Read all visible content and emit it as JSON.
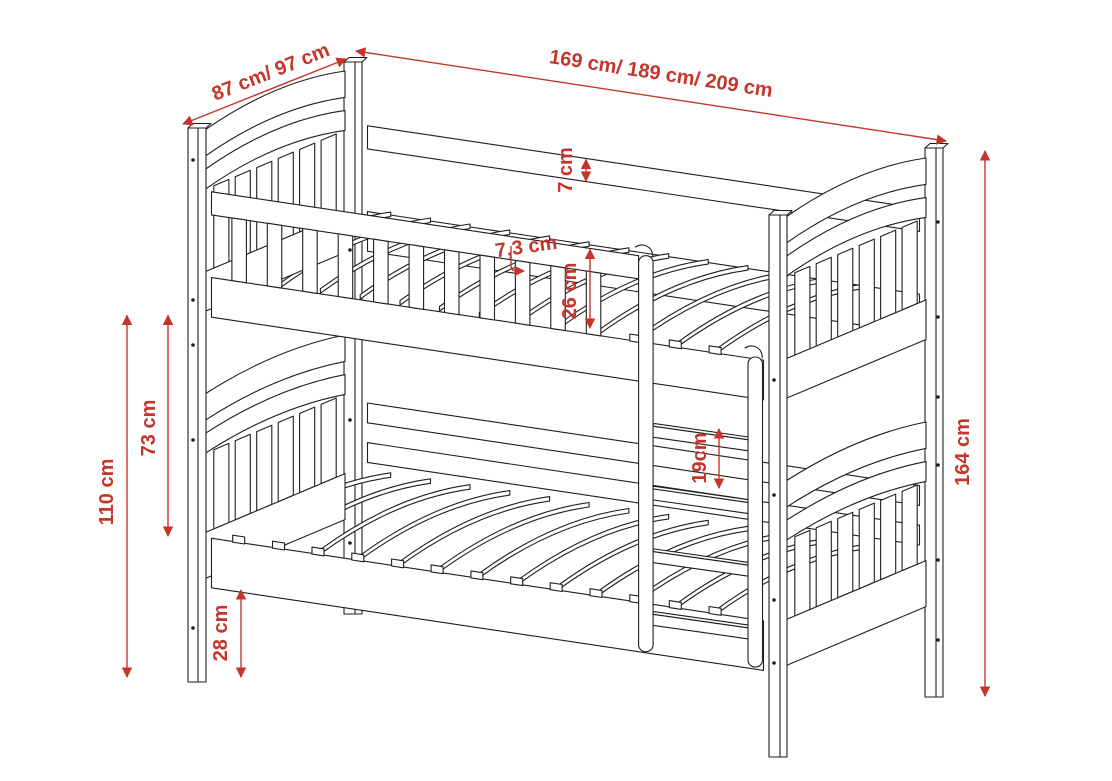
{
  "labels": {
    "width": "87 cm/ 97 cm",
    "length": "169 cm/ 189 cm/ 209 cm",
    "board_thickness": "7 cm",
    "slat_gap": "7,3 cm",
    "guard_height": "26 cm",
    "between_bunks": "73 cm",
    "upper_underside": "110 cm",
    "under_bed": "28 cm",
    "rung_spacing": "19cm",
    "total_height": "164 cm"
  },
  "colors": {
    "dimension_red": "#c5352c",
    "line": "#1f1f1f",
    "background": "#ffffff"
  }
}
